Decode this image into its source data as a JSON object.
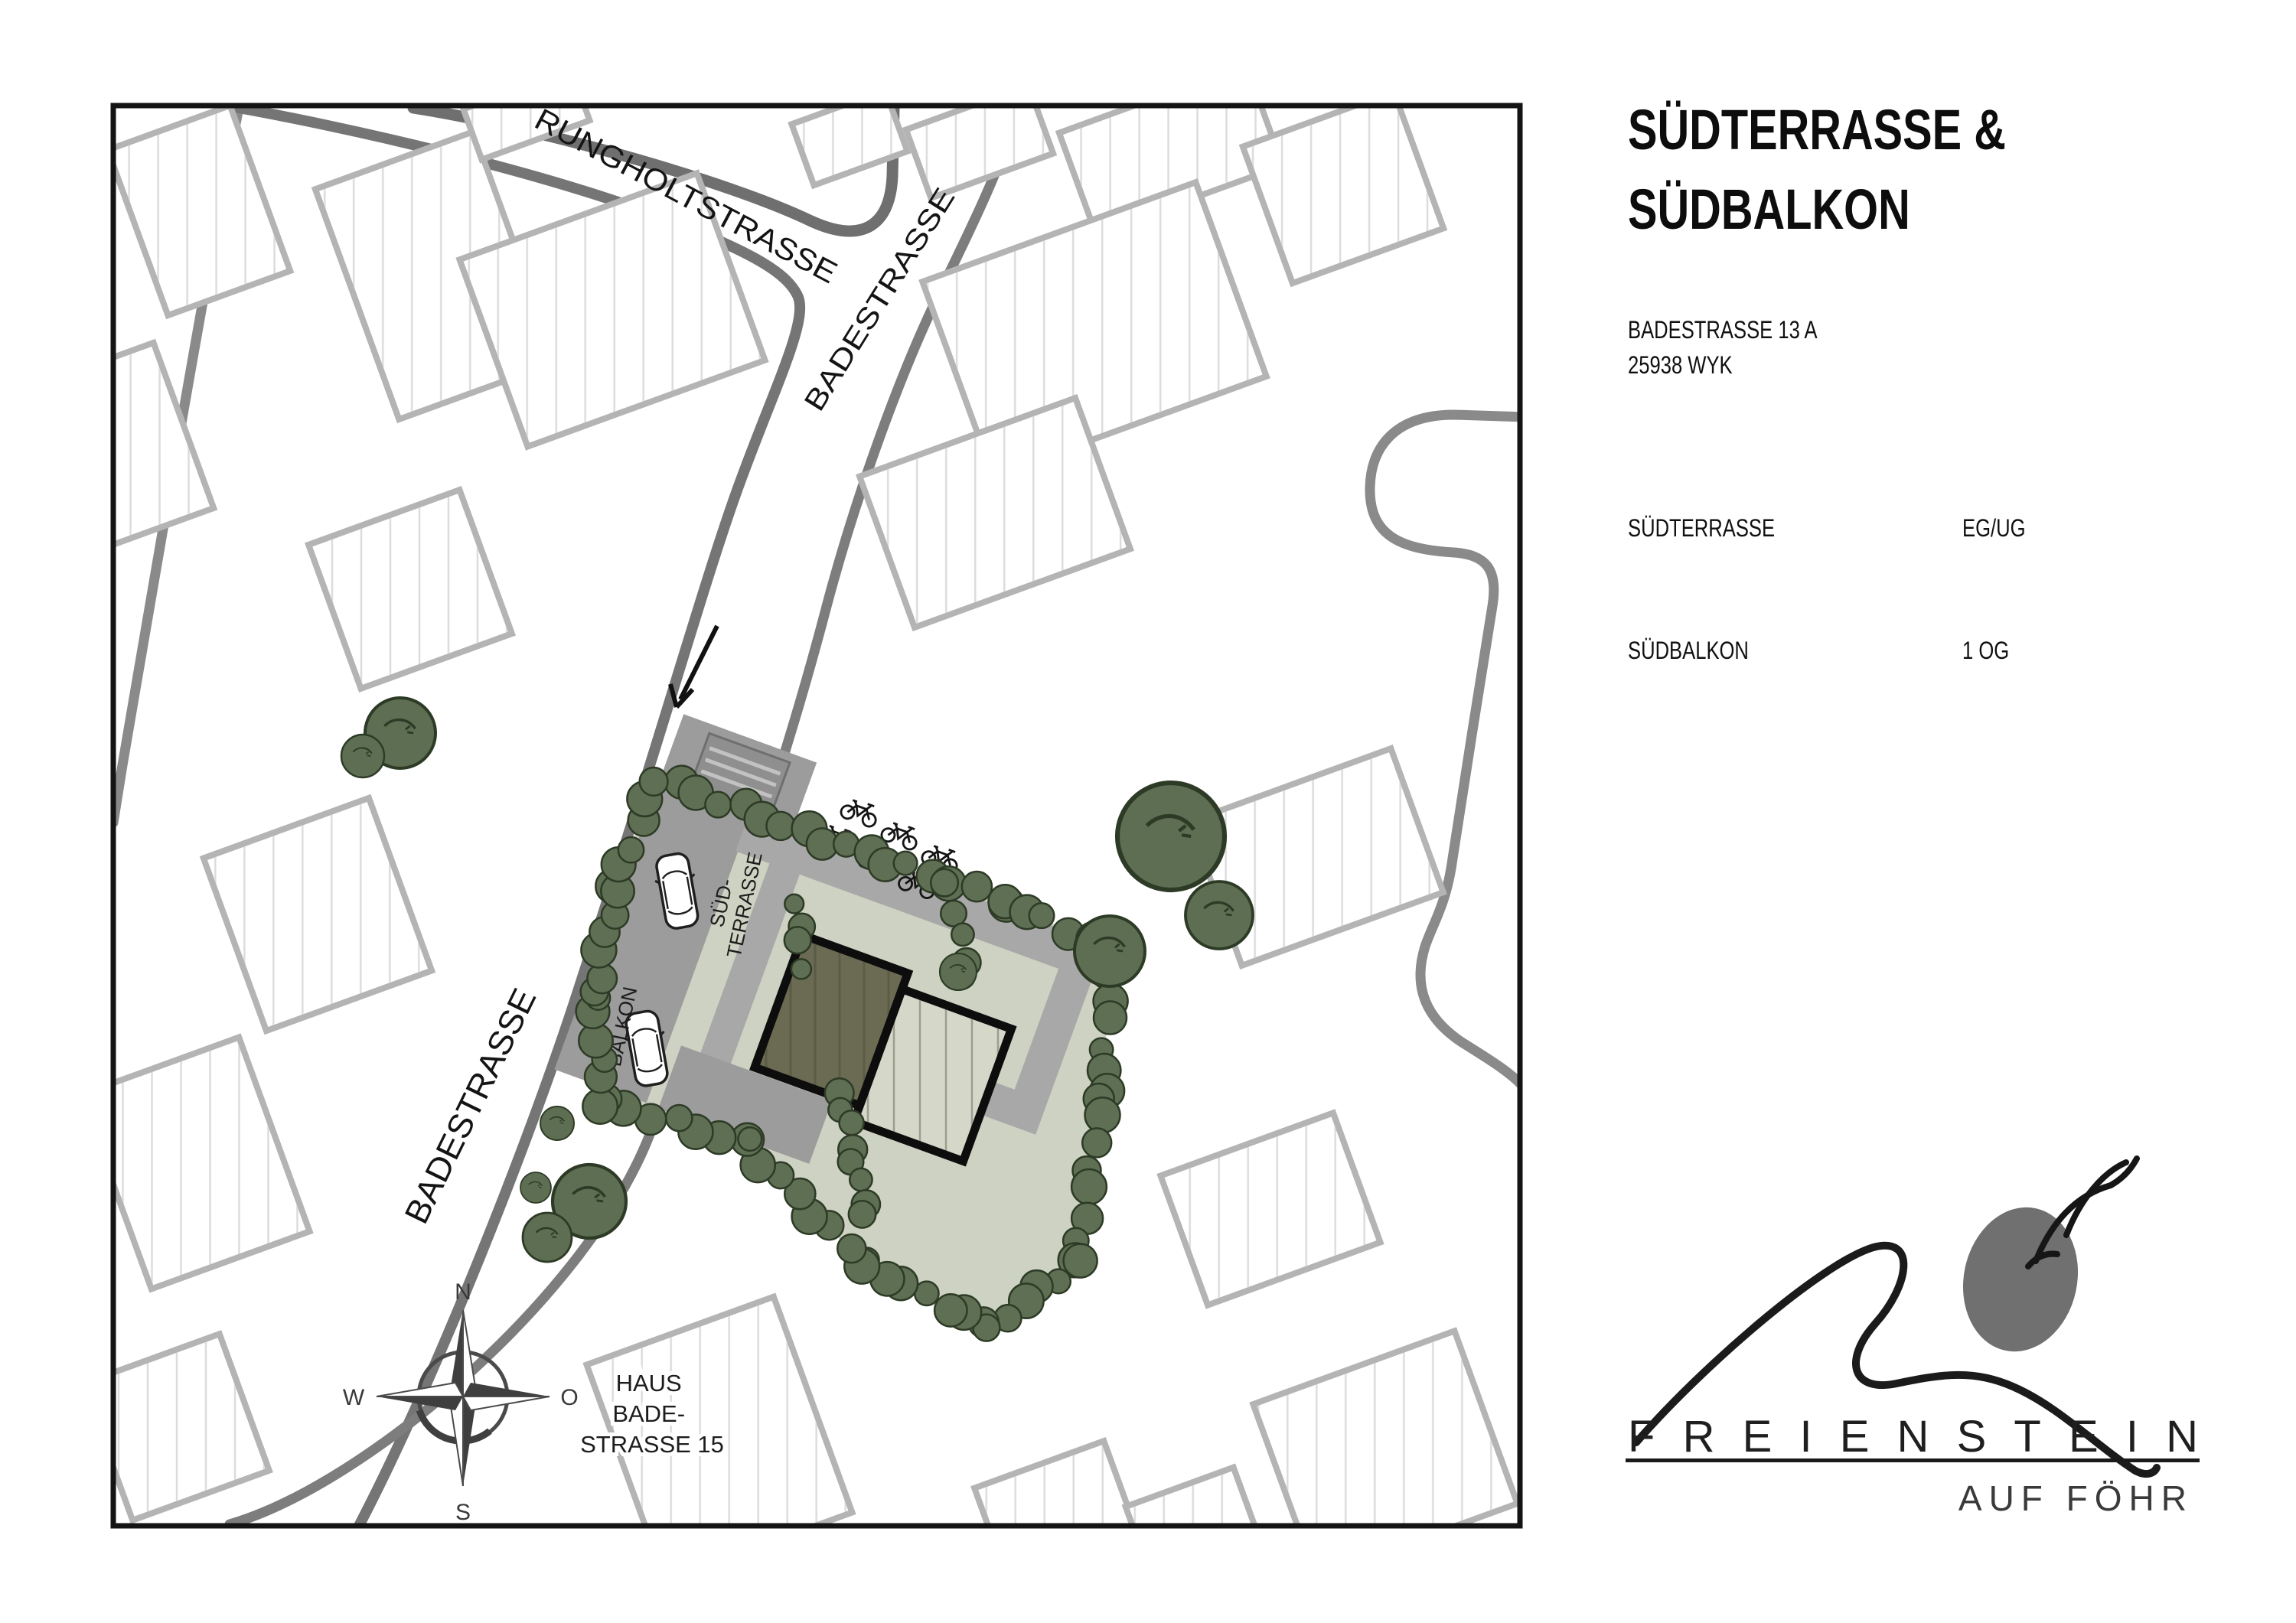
{
  "panel": {
    "title_line1": "SÜDTERRASSE &",
    "title_line2": "SÜDBALKON",
    "address_line1": "BADESTRASSE 13 A",
    "address_line2": "25938 WYK",
    "units": [
      {
        "name": "SÜDTERRASSE",
        "floor": "EG/UG"
      },
      {
        "name": "SÜDBALKON",
        "floor": "1 OG"
      }
    ]
  },
  "logo": {
    "brand": "FREIENSTEIN",
    "tagline": "AUF FÖHR"
  },
  "map": {
    "streets": {
      "rungholtstrasse": "RUNGHOLTSTRASSE",
      "badestrasse_upper": "BADESTRASSE",
      "badestrasse_lower": "BADESTRASSE"
    },
    "site": {
      "terrace_line1": "SÜD-",
      "terrace_line2": "TERRASSE",
      "balcony_line1": "SÜD-",
      "balcony_line2": "BALKON"
    },
    "house_label": {
      "line1": "HAUS",
      "line2": "BADE-",
      "line3": "STRASSE 15"
    },
    "compass": {
      "north": "N",
      "east": "O",
      "south": "S",
      "west": "W"
    },
    "colors": {
      "hedge": "#5e6f53",
      "tree": "#5d6e52",
      "plot": "#ced2c2",
      "driveway": "#9c9c9c",
      "walkway": "#a8a8a8",
      "building_dark": "#6b6b53",
      "building_light": "#d5d7c9",
      "building_outline": "#0d0d0d",
      "street": "#7d7d7d"
    }
  }
}
